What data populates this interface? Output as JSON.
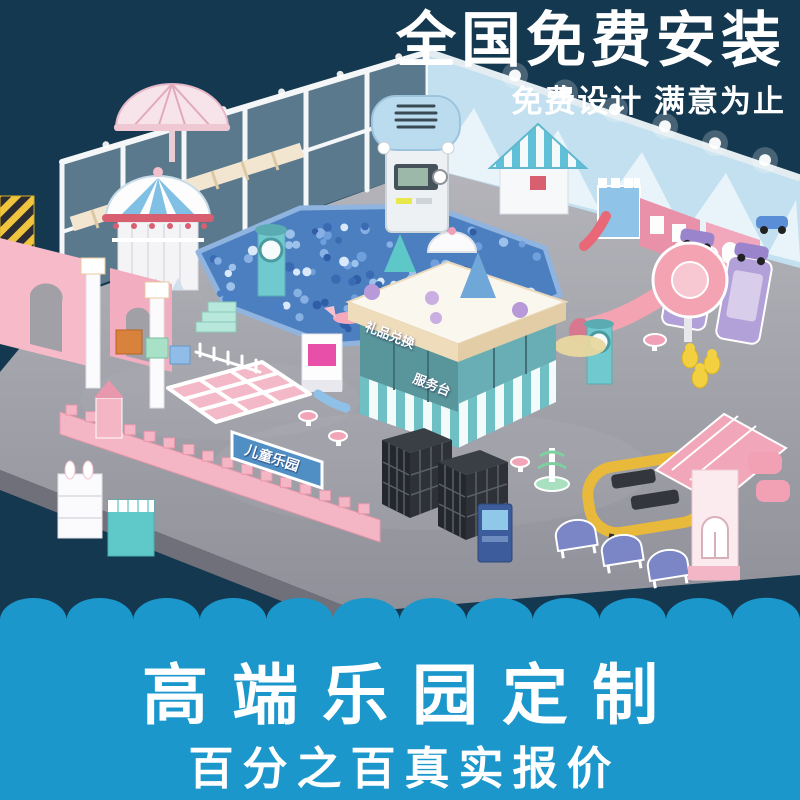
{
  "header": {
    "title": "全国免费安装",
    "subtitle": "免费设计 满意为止"
  },
  "footer": {
    "title": "高端乐园定制",
    "subtitle": "百分之百真实报价"
  },
  "scene": {
    "counter_roof_label": "礼品兑换",
    "counter_front_label": "服务台",
    "castle_gate_label": "儿童乐园"
  },
  "palette": {
    "navy": "#14384f",
    "band_blue": "#1b97cc",
    "headline_text": "#ffffff",
    "band_text": "#ffffff",
    "floor_gray": "#a6a6ae",
    "pastel_pink": "#f2afc1",
    "pastel_teal": "#6fc9ce",
    "baby_blue": "#badcee",
    "ball_pit_blue": "#4c7fc0",
    "accent_yellow": "#e9b93c",
    "accent_purple": "#b2a0d8"
  }
}
